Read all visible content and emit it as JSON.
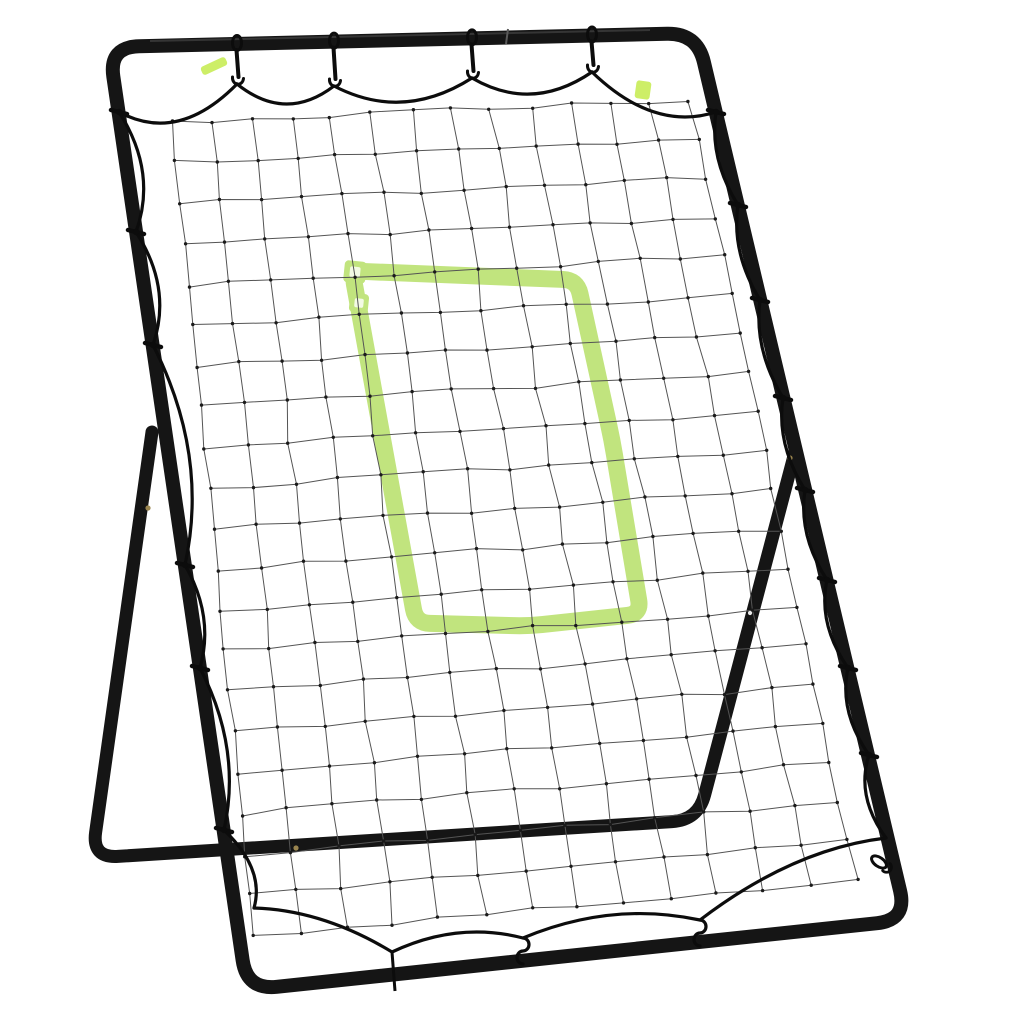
{
  "scene": {
    "label": "Black metal pitchback rebounder with bungee-laced net and green strike zone target",
    "background": "#ffffff",
    "width": 1024,
    "height": 1024
  },
  "colors": {
    "frame": "#151515",
    "frame_highlight": "#3d3d3d",
    "cord": "#0c0c0c",
    "net_line": "#545454",
    "net_knot": "#1a1a1a",
    "zone_green": "#c1e47e",
    "tag_green": "#cdee67",
    "marker_inner": "#f3fae5",
    "bolt": "#9a854f",
    "glint": "#e9e9e9",
    "seam": "#5a5a5a"
  },
  "frame": {
    "tube_width": 14,
    "rear_tube_width": 13,
    "corner_radius": 30,
    "main_points": [
      [
        109,
        47
      ],
      [
        697,
        33
      ],
      [
        907,
        920
      ],
      [
        247,
        990
      ]
    ],
    "rear_points": [
      [
        152,
        432
      ],
      [
        92,
        858
      ],
      [
        698,
        820
      ],
      [
        795,
        452
      ]
    ],
    "rear_radius": 26,
    "top_bar": {
      "x1": 109,
      "y1": 47,
      "x2": 697,
      "y2": 33
    },
    "highlight": {
      "x1": 150,
      "y1": 41,
      "x2": 650,
      "y2": 30
    },
    "seams": [
      [
        508,
        36
      ]
    ],
    "bolts": [
      [
        148,
        508
      ],
      [
        296,
        848
      ],
      [
        790,
        458
      ]
    ],
    "glints": [
      [
        750,
        613
      ],
      [
        872,
        812
      ]
    ]
  },
  "net": {
    "corners": {
      "tl": [
        172,
        122
      ],
      "tr": [
        690,
        100
      ],
      "br": [
        856,
        880
      ],
      "bl": [
        254,
        936
      ]
    },
    "cols": 13,
    "rows": 20,
    "wobble": 2.4,
    "seed": 7,
    "line_width": 1,
    "knot_r": 1.7
  },
  "strike_zone": {
    "band_width": 17,
    "outline": [
      [
        352,
        271
      ],
      [
        577,
        280
      ],
      [
        612,
        440
      ],
      [
        641,
        614
      ],
      [
        528,
        626
      ],
      [
        416,
        623
      ]
    ],
    "markers": [
      {
        "cx": 355,
        "cy": 272,
        "s": 22,
        "rot": 6
      },
      {
        "cx": 359,
        "cy": 303,
        "s": 19,
        "rot": 6
      }
    ]
  },
  "tags": [
    {
      "cx": 214,
      "cy": 66,
      "w": 27,
      "h": 9,
      "rot": -25
    },
    {
      "cx": 643,
      "cy": 90,
      "w": 15,
      "h": 18,
      "rot": 8
    }
  ],
  "cord": {
    "width": 3.2,
    "sides": [
      {
        "name": "top",
        "normal": [
          0,
          1
        ],
        "anchors": [
          [
            119,
            112
          ],
          [
            237,
            84
          ],
          [
            334,
            86
          ],
          [
            472,
            78
          ],
          [
            592,
            72
          ],
          [
            716,
            112
          ]
        ],
        "bulges": [
          46,
          38,
          40,
          38,
          40
        ]
      },
      {
        "name": "left",
        "normal": [
          1,
          0
        ],
        "anchors": [
          [
            119,
            112
          ],
          [
            136,
            232
          ],
          [
            153,
            345
          ],
          [
            185,
            565
          ],
          [
            200,
            668
          ],
          [
            224,
            830
          ],
          [
            254,
            908
          ]
        ],
        "bulges": [
          30,
          28,
          40,
          22,
          30,
          26
        ]
      },
      {
        "name": "right",
        "normal": [
          -1,
          0
        ],
        "anchors": [
          [
            716,
            112
          ],
          [
            738,
            205
          ],
          [
            760,
            300
          ],
          [
            783,
            398
          ],
          [
            805,
            490
          ],
          [
            827,
            580
          ],
          [
            848,
            668
          ],
          [
            869,
            755
          ],
          [
            886,
            838
          ]
        ],
        "bulges": [
          18,
          18,
          18,
          18,
          18,
          20,
          20,
          22
        ]
      },
      {
        "name": "bottom",
        "normal": [
          0,
          -1
        ],
        "anchors": [
          [
            886,
            838
          ],
          [
            700,
            920
          ],
          [
            523,
            938
          ],
          [
            392,
            952
          ],
          [
            254,
            908
          ]
        ],
        "bulges": [
          30,
          28,
          24,
          20
        ]
      }
    ]
  },
  "hooks": {
    "top": [
      [
        237,
        84
      ],
      [
        334,
        86
      ],
      [
        472,
        78
      ],
      [
        592,
        72
      ]
    ],
    "left_ties": [
      [
        119,
        112
      ],
      [
        136,
        232
      ],
      [
        153,
        345
      ],
      [
        185,
        565
      ],
      [
        200,
        668
      ],
      [
        224,
        830
      ]
    ],
    "right_ties": [
      [
        716,
        112
      ],
      [
        738,
        205
      ],
      [
        760,
        300
      ],
      [
        783,
        398
      ],
      [
        805,
        490
      ],
      [
        827,
        580
      ],
      [
        848,
        668
      ],
      [
        869,
        755
      ]
    ],
    "bottom_s": [
      [
        523,
        938
      ],
      [
        700,
        920
      ]
    ],
    "bottom_tie": {
      "x1": 392,
      "y1": 952,
      "x2": 395,
      "y2": 991
    },
    "corner_hook": [
      879,
      862
    ]
  }
}
